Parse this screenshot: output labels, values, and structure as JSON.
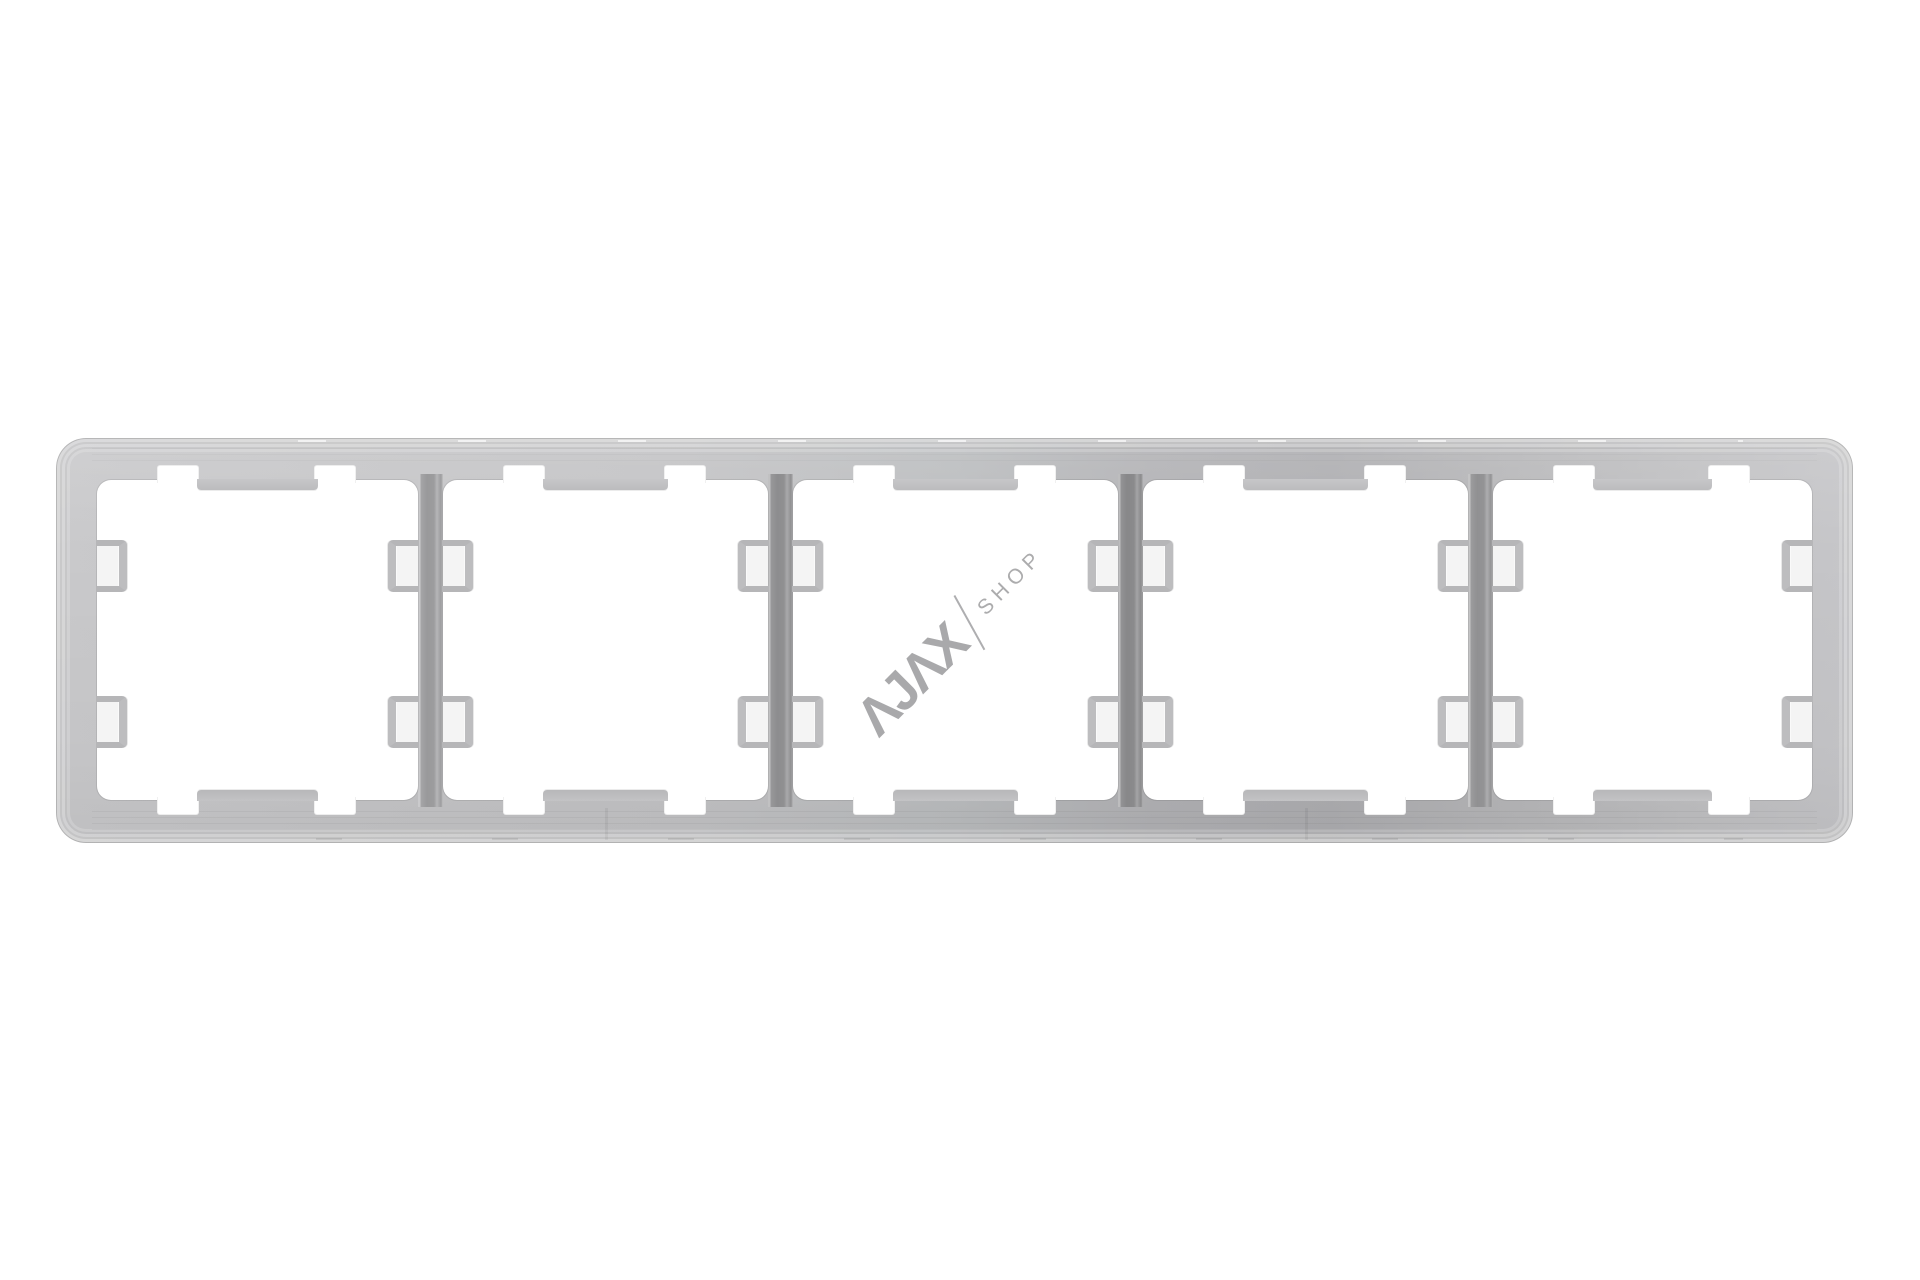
{
  "product": {
    "name": "Frame (5 seats)",
    "description": "Translucent five-gang wall switch frame, front view on white background",
    "openings_count": 5
  },
  "watermark": {
    "brand": "AJAX",
    "brand_display": "ΛJΛX",
    "separator": "/",
    "store_label": "SHOP",
    "rotation_deg": -45,
    "color": "#a2a2a4"
  },
  "colors": {
    "page_background": "#ffffff",
    "frame_light": "#c9c9cb",
    "frame_mid": "#c0c0c2",
    "frame_dark": "#aeaeb1",
    "divider": "#9b9b9d",
    "clip": "#bdbdbf",
    "opening": "#ffffff"
  }
}
